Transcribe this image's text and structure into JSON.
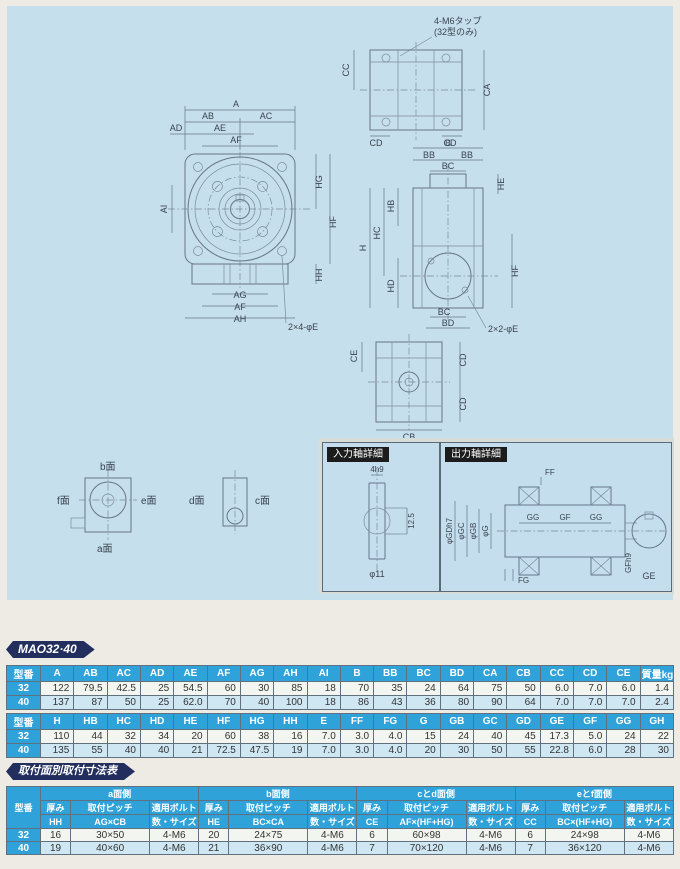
{
  "page": {
    "badge_model": "MAO32·40",
    "badge_table3": "取付面別取付寸法表"
  },
  "drawings": {
    "front": {
      "a": "A",
      "ab": "AB",
      "ac": "AC",
      "ad": "AD",
      "ae": "AE",
      "af_top": "AF",
      "ai": "AI",
      "hg": "HG",
      "hf": "HF",
      "hh": "HH",
      "ag": "AG",
      "af_bottom": "AF",
      "ah": "AH",
      "note": "2×4-φE"
    },
    "top": {
      "note1": "4-M6タップ",
      "note2": "(32型のみ)",
      "cc": "CC",
      "ca": "CA",
      "cd_left": "CD",
      "cd_right": "CD"
    },
    "side": {
      "b": "B",
      "bb_left": "BB",
      "bb_right": "BB",
      "bc_top": "BC",
      "hb": "HB",
      "h": "H",
      "hc": "HC",
      "hd": "HD",
      "he": "HE",
      "hf": "HF",
      "bc_bottom": "BC",
      "bd": "BD",
      "note": "2×2-φE"
    },
    "bottom": {
      "ce": "CE",
      "cd_top": "CD",
      "cd_bottom": "CD",
      "cb": "CB"
    },
    "faces": {
      "b": "b面",
      "f": "f面",
      "e": "e面",
      "d": "d面",
      "c": "c面",
      "a": "a面"
    },
    "input_detail": {
      "title": "入力軸詳細",
      "key": "4h9",
      "across": "12.5",
      "dia": "φ11"
    },
    "output_detail": {
      "title": "出力軸詳細",
      "ff": "FF",
      "fg": "FG",
      "gd": "φGDh7",
      "gc": "φGC",
      "gb": "φGB",
      "g": "φG",
      "gg1": "GG",
      "gf": "GF",
      "gg2": "GG",
      "key": "GFh9",
      "ge": "GE"
    }
  },
  "t1": {
    "col0": "型番",
    "headers": [
      "A",
      "AB",
      "AC",
      "AD",
      "AE",
      "AF",
      "AG",
      "AH",
      "AI",
      "B",
      "BB",
      "BC",
      "BD",
      "CA",
      "CB",
      "CC",
      "CD",
      "CE",
      "質量kg"
    ],
    "rows": [
      {
        "model": "32",
        "values": [
          "122",
          "79.5",
          "42.5",
          "25",
          "54.5",
          "60",
          "30",
          "85",
          "18",
          "70",
          "35",
          "24",
          "64",
          "75",
          "50",
          "6.0",
          "7.0",
          "6.0",
          "1.4"
        ]
      },
      {
        "model": "40",
        "values": [
          "137",
          "87",
          "50",
          "25",
          "62.0",
          "70",
          "40",
          "100",
          "18",
          "86",
          "43",
          "36",
          "80",
          "90",
          "64",
          "7.0",
          "7.0",
          "7.0",
          "2.4"
        ]
      }
    ]
  },
  "t2": {
    "col0": "型番",
    "headers": [
      "H",
      "HB",
      "HC",
      "HD",
      "HE",
      "HF",
      "HG",
      "HH",
      "E",
      "FF",
      "FG",
      "G",
      "GB",
      "GC",
      "GD",
      "GE",
      "GF",
      "GG",
      "GH"
    ],
    "rows": [
      {
        "model": "32",
        "values": [
          "110",
          "44",
          "32",
          "34",
          "20",
          "60",
          "38",
          "16",
          "7.0",
          "3.0",
          "4.0",
          "15",
          "24",
          "40",
          "45",
          "17.3",
          "5.0",
          "24",
          "22"
        ]
      },
      {
        "model": "40",
        "values": [
          "135",
          "55",
          "40",
          "40",
          "21",
          "72.5",
          "47.5",
          "19",
          "7.0",
          "3.0",
          "4.0",
          "20",
          "30",
          "50",
          "55",
          "22.8",
          "6.0",
          "28",
          "30"
        ]
      }
    ]
  },
  "t3": {
    "col0": "型番",
    "groups": [
      {
        "name": "a面側",
        "thick_l": "厚み",
        "pitch_l": "取付ピッチ",
        "bolt_l": "適用ボルト",
        "thick_s": "HH",
        "pitch_s": "AG×CB",
        "bolt_s": "数・サイズ"
      },
      {
        "name": "b面側",
        "thick_l": "厚み",
        "pitch_l": "取付ピッチ",
        "bolt_l": "適用ボルト",
        "thick_s": "HE",
        "pitch_s": "BC×CA",
        "bolt_s": "数・サイズ"
      },
      {
        "name": "cとd面側",
        "thick_l": "厚み",
        "pitch_l": "取付ピッチ",
        "bolt_l": "適用ボルト",
        "thick_s": "CE",
        "pitch_s": "AF×(HF+HG)",
        "bolt_s": "数・サイズ"
      },
      {
        "name": "eとf面側",
        "thick_l": "厚み",
        "pitch_l": "取付ピッチ",
        "bolt_l": "適用ボルト",
        "thick_s": "CC",
        "pitch_s": "BC×(HF+HG)",
        "bolt_s": "数・サイズ"
      }
    ],
    "rows": [
      {
        "model": "32",
        "values": [
          "16",
          "30×50",
          "4-M6",
          "20",
          "24×75",
          "4-M6",
          "6",
          "60×98",
          "4-M6",
          "6",
          "24×98",
          "4-M6"
        ]
      },
      {
        "model": "40",
        "values": [
          "19",
          "40×60",
          "4-M6",
          "21",
          "36×90",
          "4-M6",
          "7",
          "70×120",
          "4-M6",
          "7",
          "36×120",
          "4-M6"
        ]
      }
    ]
  }
}
